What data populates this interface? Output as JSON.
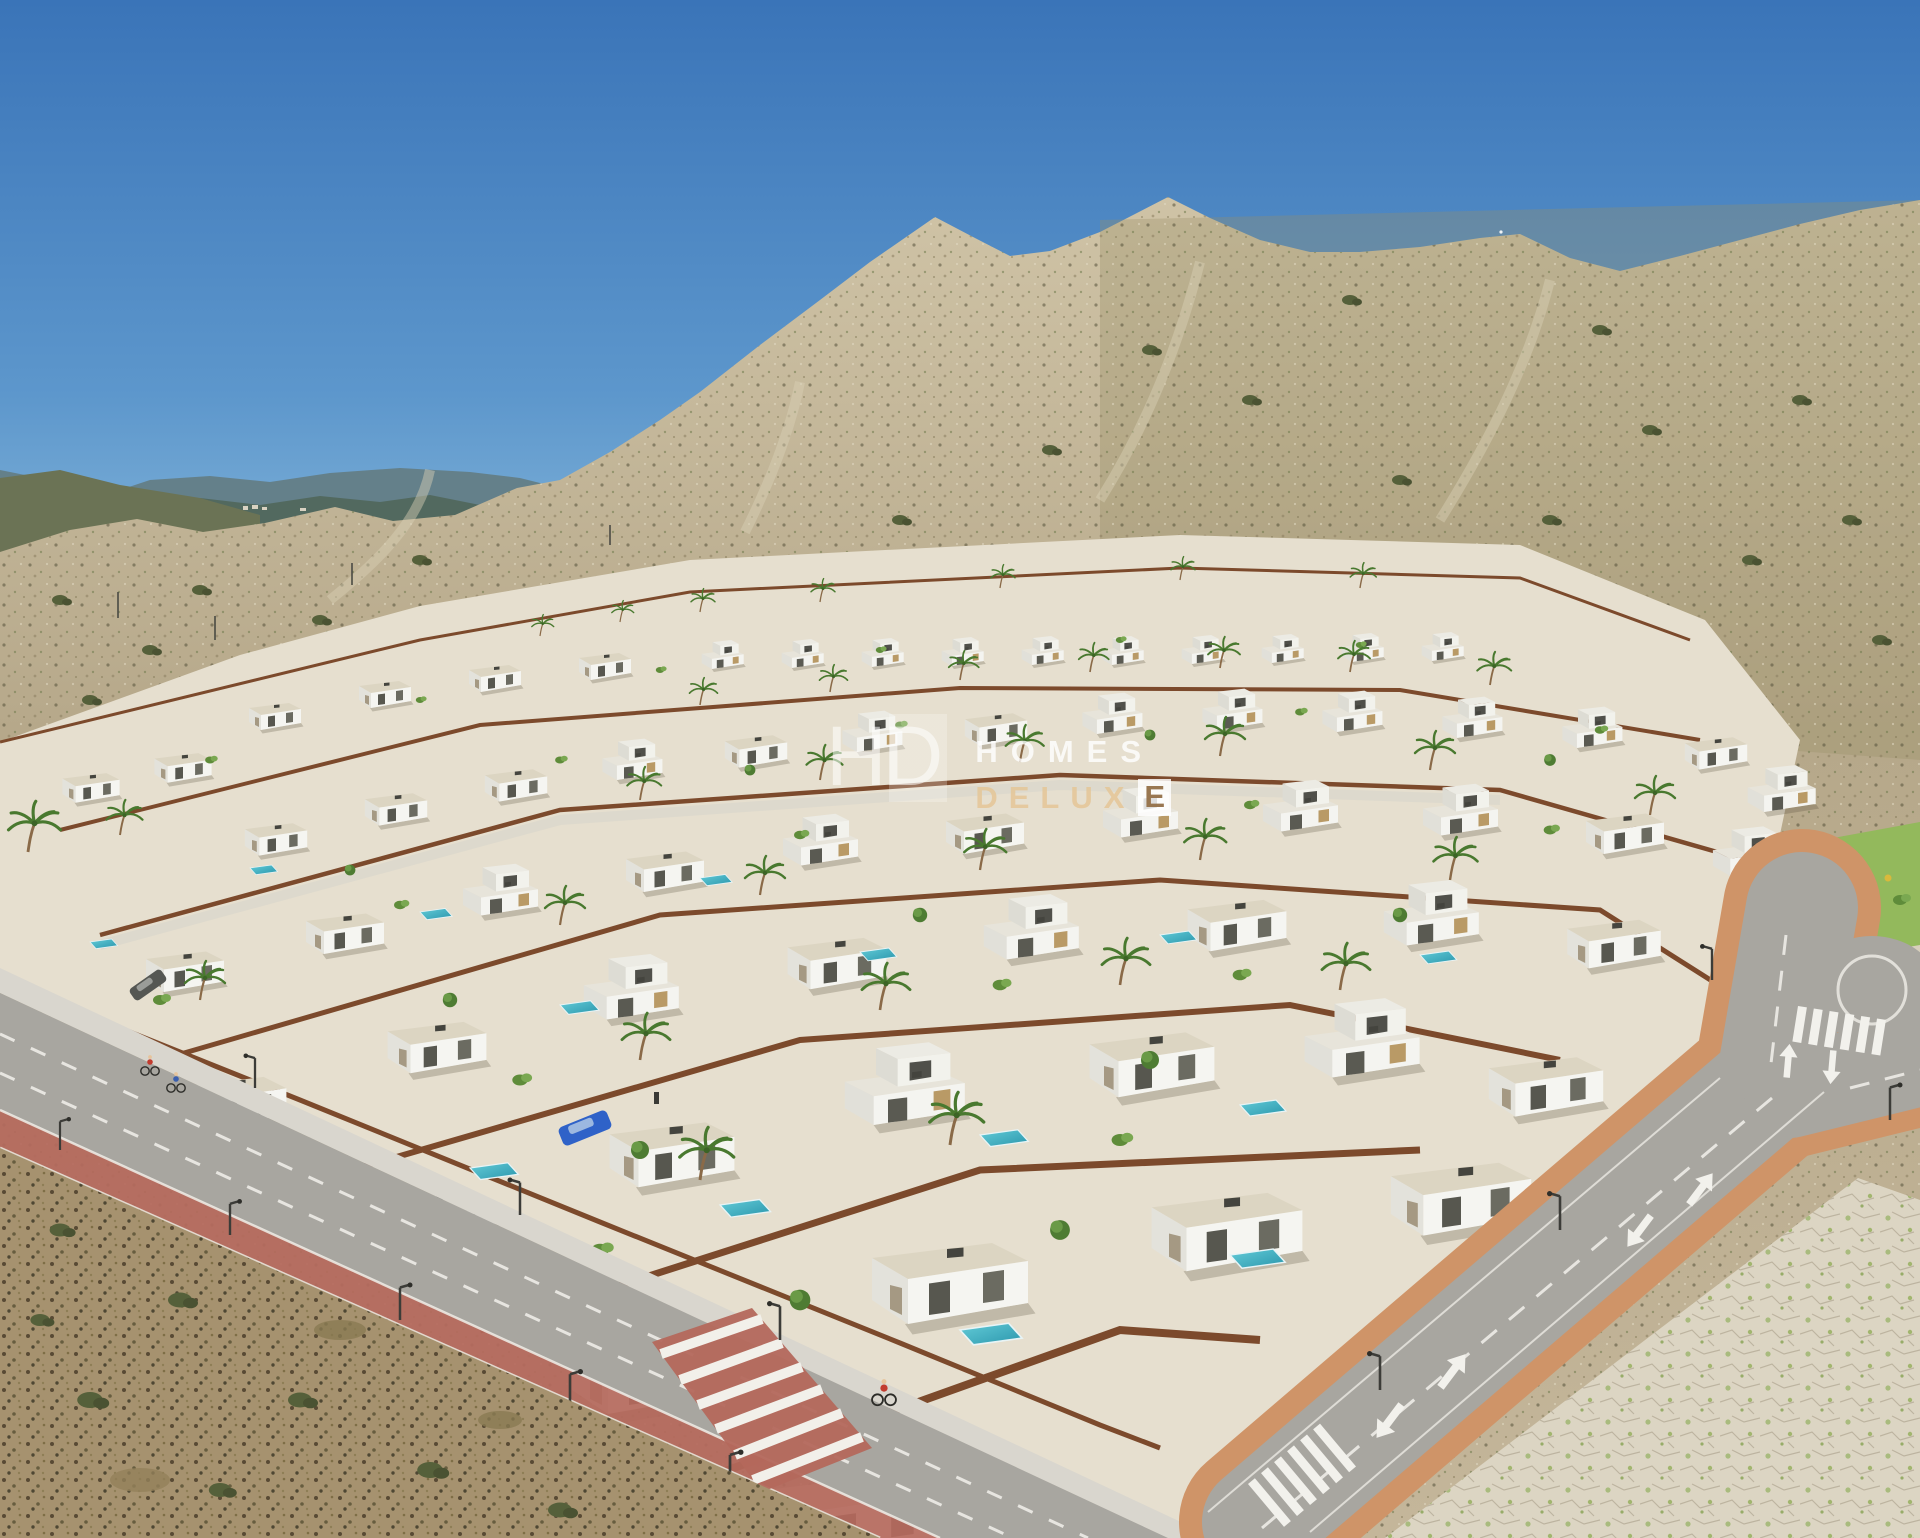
{
  "image": {
    "kind": "aerial 3D architectural render",
    "subject": "gated development of modern white flat-roof villas with private pools in an arid mountain valley",
    "background": "scrub-covered desert hills under a clear blue sky, yellow industrial building with solar roof on the slope",
    "foreground": "asphalt avenues with red bike lanes, zebra crossings, lane arrows, cyclists and dry scrubland corners"
  },
  "watermark": {
    "monogram": "HD",
    "line1": "HOMES",
    "line2_main": "DELUX",
    "line2_accent": "E"
  },
  "palette": {
    "sky_top": "#3a74b8",
    "sky_horizon": "#9cc8e2",
    "far_mountains": "#5e7a84",
    "hill_scrub_tan": "#b6a88a",
    "villa_white": "#f4f4f0",
    "roof_beige": "#dcd5c2",
    "rust_wall": "#7c4a2c",
    "pool_turquoise": "#3fb3c4",
    "vegetation_green": "#5f8c3a",
    "asphalt_gray": "#a8a6a0",
    "bike_lane_red": "#b4685c",
    "sidewalk_terracotta": "#cf9468",
    "solar_roof_blue": "#3c5f9f",
    "industrial_building_yellow": "#d9ba62"
  }
}
